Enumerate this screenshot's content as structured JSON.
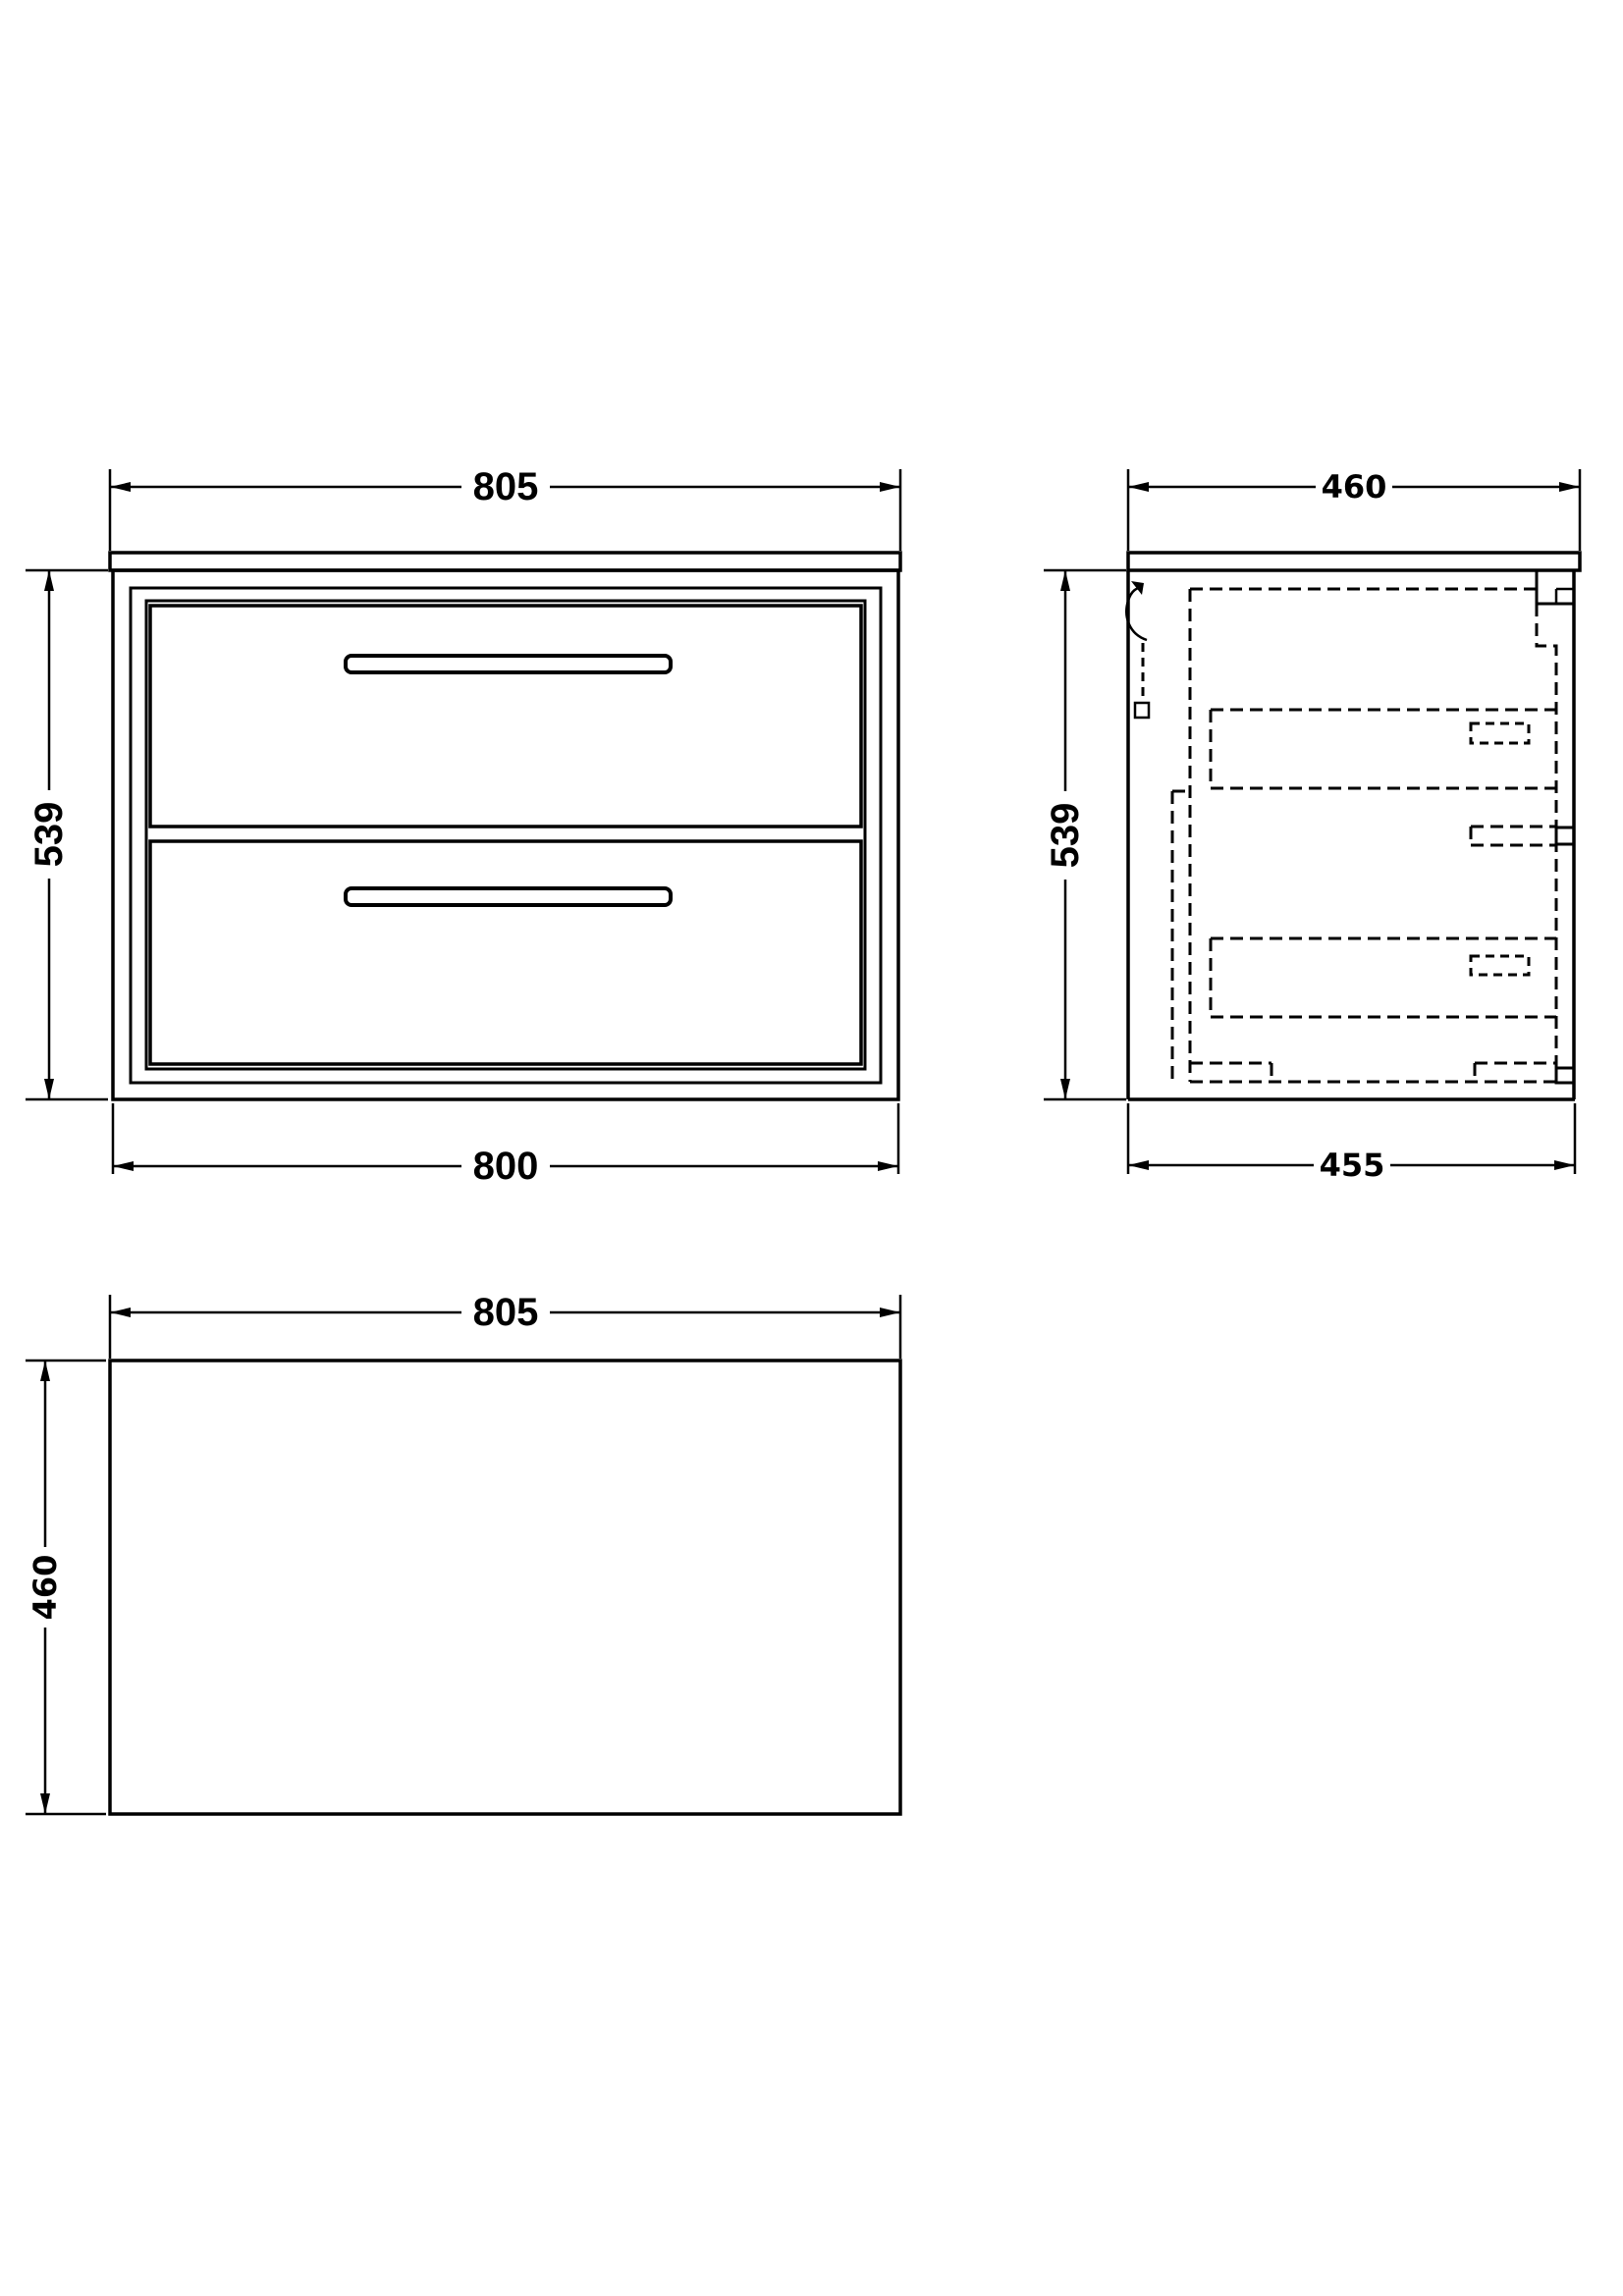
{
  "colors": {
    "ink": "#000000",
    "background": "#ffffff"
  },
  "front_view": {
    "dim_width_top": "805",
    "dim_height": "539",
    "dim_width_bottom": "800"
  },
  "side_view": {
    "dim_depth_top": "460",
    "dim_height": "539",
    "dim_depth_bottom": "455"
  },
  "plan_view": {
    "dim_width": "805",
    "dim_depth": "460"
  }
}
